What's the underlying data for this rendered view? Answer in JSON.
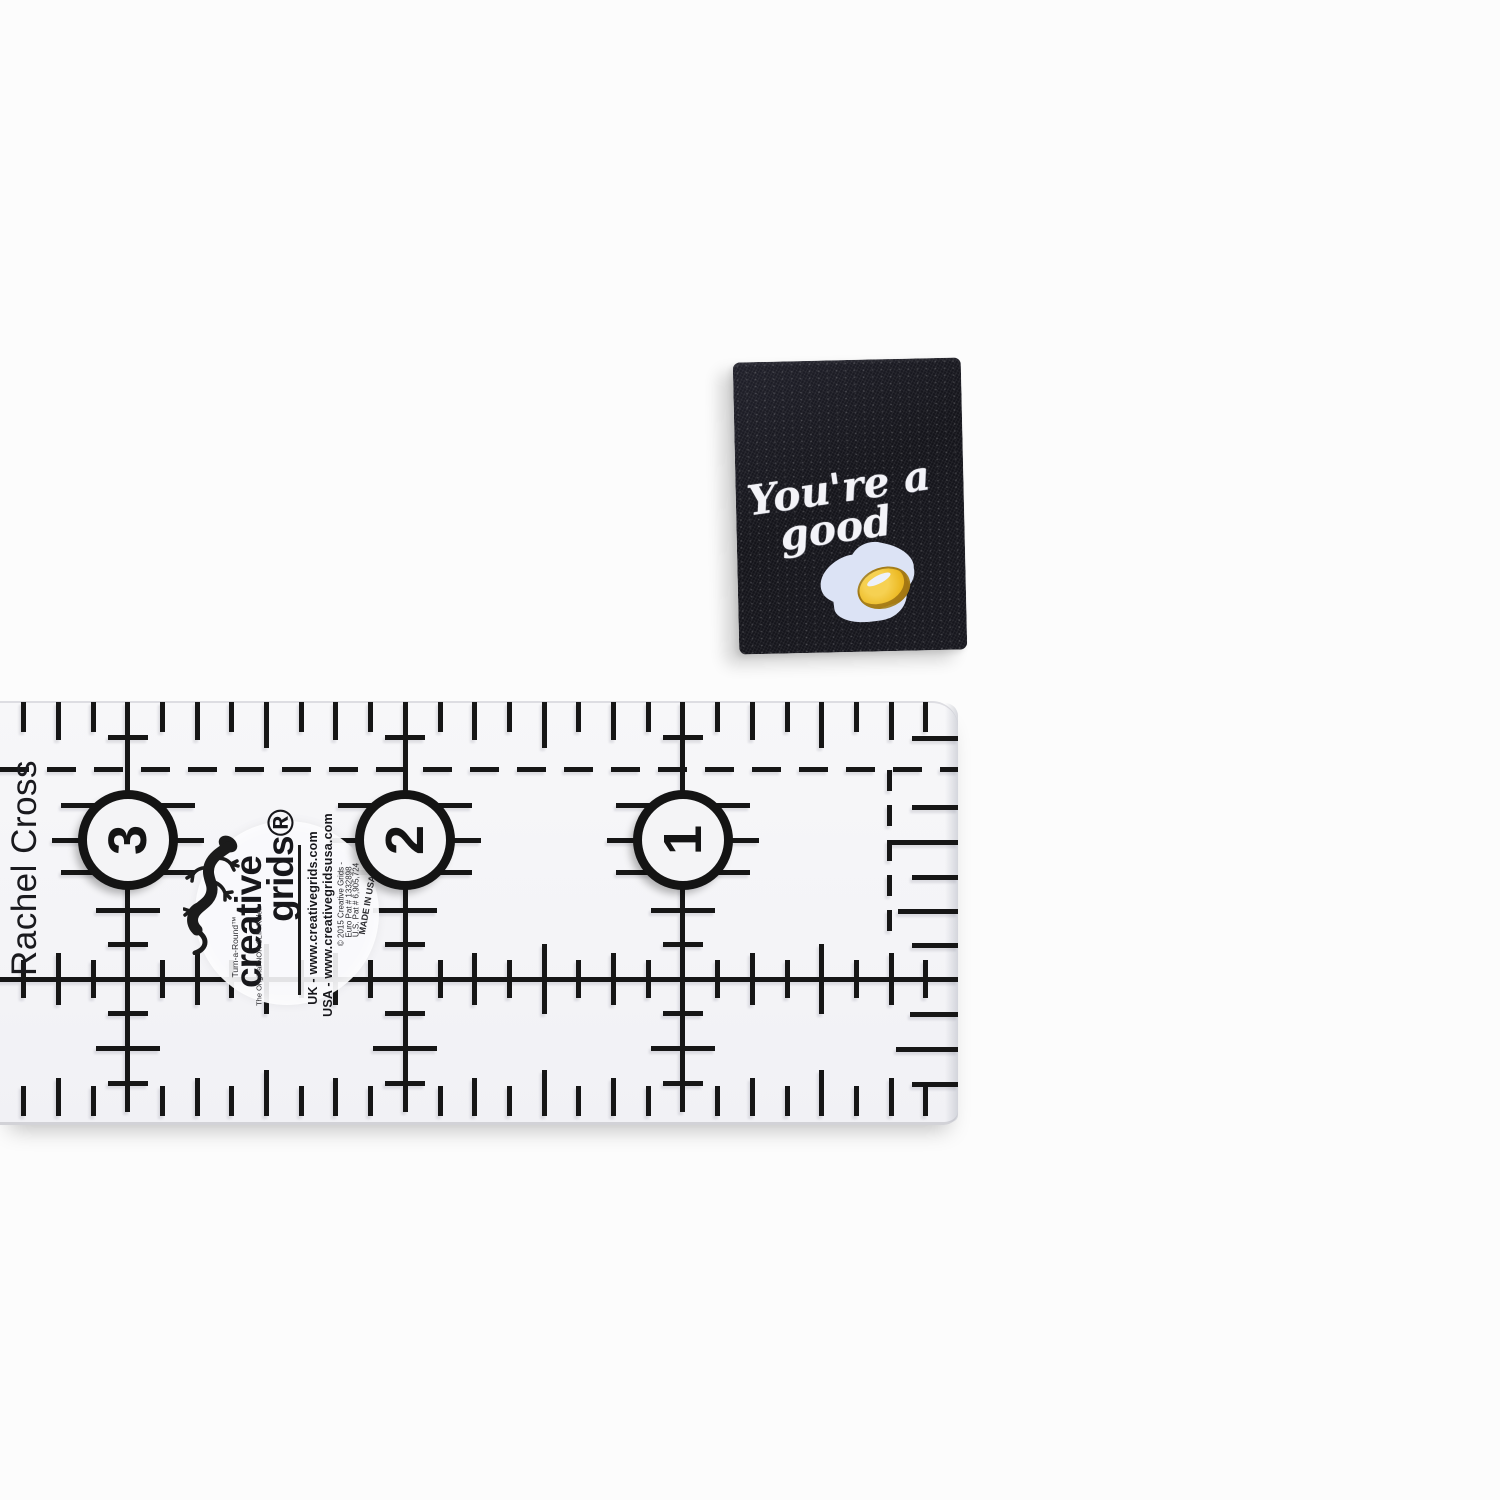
{
  "photo": {
    "background_color": "#fcfcfc"
  },
  "tag": {
    "text_line1": "You're a",
    "text_line2": "good",
    "egg_icon": "fried-egg",
    "fabric_color": "#15151c",
    "thread_color": "#f3f3f8",
    "egg_white_color": "#dce3f5",
    "egg_yolk_color": "#ecba24"
  },
  "ruler": {
    "side_label": "Rachel Cross",
    "inch_numbers": [
      "3",
      "2",
      "1"
    ],
    "marking_color": "#161616",
    "brand": {
      "gecko_icon": "gecko-logo",
      "name_line1": "creative",
      "name_line2": "grids®",
      "tagline_vertical": "Turn-a-Round™",
      "tagline_small": "The Original NON SLIP Ruler",
      "url_uk": "UK - www.creativegrids.com",
      "url_usa": "USA - www.creativegridsusa.com",
      "copyright_line": "© 2015 Creative Grids -",
      "patent_line1": "Euro Pat # 1332898",
      "patent_line2": "U.S. Pat # 6,905,724",
      "made_in": "MADE IN USA"
    }
  }
}
